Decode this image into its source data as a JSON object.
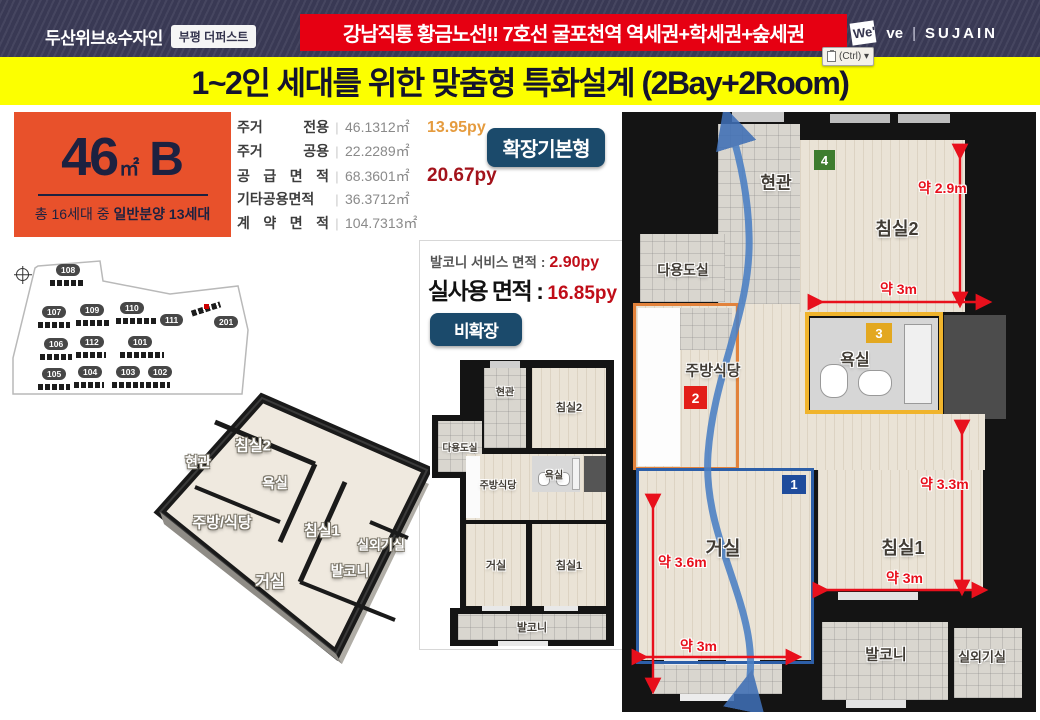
{
  "colors": {
    "banner_red": "#e60012",
    "title_yellow": "#fcff00",
    "unit_orange": "#e8512b",
    "badge_navy": "#1b4a6b",
    "dim_red": "#e8101c",
    "header_navy": "#3c3c58"
  },
  "header": {
    "brand": "두산위브&수자인",
    "brand_badge": "부평 더퍼스트",
    "banner": "강남직통 황금노선!! 7호선 굴포천역 역세권+학세권+숲세권",
    "logo": {
      "we": "We'",
      "ve": "ve",
      "divider": "|",
      "sujain": "SUJAIN"
    },
    "paste_label": "(Ctrl) ▾"
  },
  "title": "1~2인 세대를 위한 맞춤형 특화설계 (2Bay+2Room)",
  "unit_card": {
    "size": "46",
    "size_unit": "㎡",
    "type": "B",
    "note_prefix": "총 16세대 중 ",
    "note_bold": "일반분양 13세대"
  },
  "area_table": {
    "rows": [
      {
        "label": "주거 전용",
        "value": "46.1312㎡",
        "py": "13.95py"
      },
      {
        "label": "주거 공용",
        "value": "22.2289㎡",
        "py": ""
      },
      {
        "label": "공 급 면 적",
        "value": "68.3601㎡",
        "py": "20.67py"
      },
      {
        "label": "기타공용면적",
        "value": "36.3712㎡",
        "py": ""
      },
      {
        "label": "계 약 면 적",
        "value": "104.7313㎡",
        "py": ""
      }
    ]
  },
  "expand_badge": "확장기본형",
  "balcony_panel": {
    "service_label": "발코니 서비스 면적",
    "colon": ":",
    "service_value": "2.90py",
    "actual_label": "실사용 면적",
    "actual_colon": ":",
    "actual_value": "16.85py",
    "badge": "비확장"
  },
  "site_plan": {
    "buildings": [
      "108",
      "107",
      "109",
      "110",
      "111",
      "201",
      "106",
      "112",
      "101",
      "105",
      "104",
      "103",
      "102"
    ],
    "highlighted": "201"
  },
  "iso_plan": {
    "entrance": "현관",
    "bedroom2": "침실2",
    "bath": "욕실",
    "kitchen": "주방/식당",
    "bedroom1": "침실1",
    "outdoor_unit": "실외기실",
    "balcony": "발코니",
    "living": "거실"
  },
  "small_plan": {
    "entrance": "현관",
    "bedroom2": "침실2",
    "utility": "다용도실",
    "kitchen": "주방식당",
    "bath": "욕실",
    "living": "거실",
    "bedroom1": "침실1",
    "balcony": "발코니"
  },
  "big_plan": {
    "entrance": "현관",
    "utility": "다용도실",
    "kitchen": "주방식당",
    "bath": "욕실",
    "bedroom2": "침실2",
    "bedroom1": "침실1",
    "living": "거실",
    "balcony": "발코니",
    "outdoor_unit": "실외기실",
    "dims": {
      "bed2_h": "약 2.9m",
      "bed2_w": "약 3m",
      "bed1_h": "약 3.3m",
      "bed1_w": "약 3m",
      "living_h": "약 3.6m",
      "living_w": "약 3m"
    },
    "markers": {
      "m1": "1",
      "m2": "2",
      "m3": "3",
      "m4": "4"
    }
  }
}
